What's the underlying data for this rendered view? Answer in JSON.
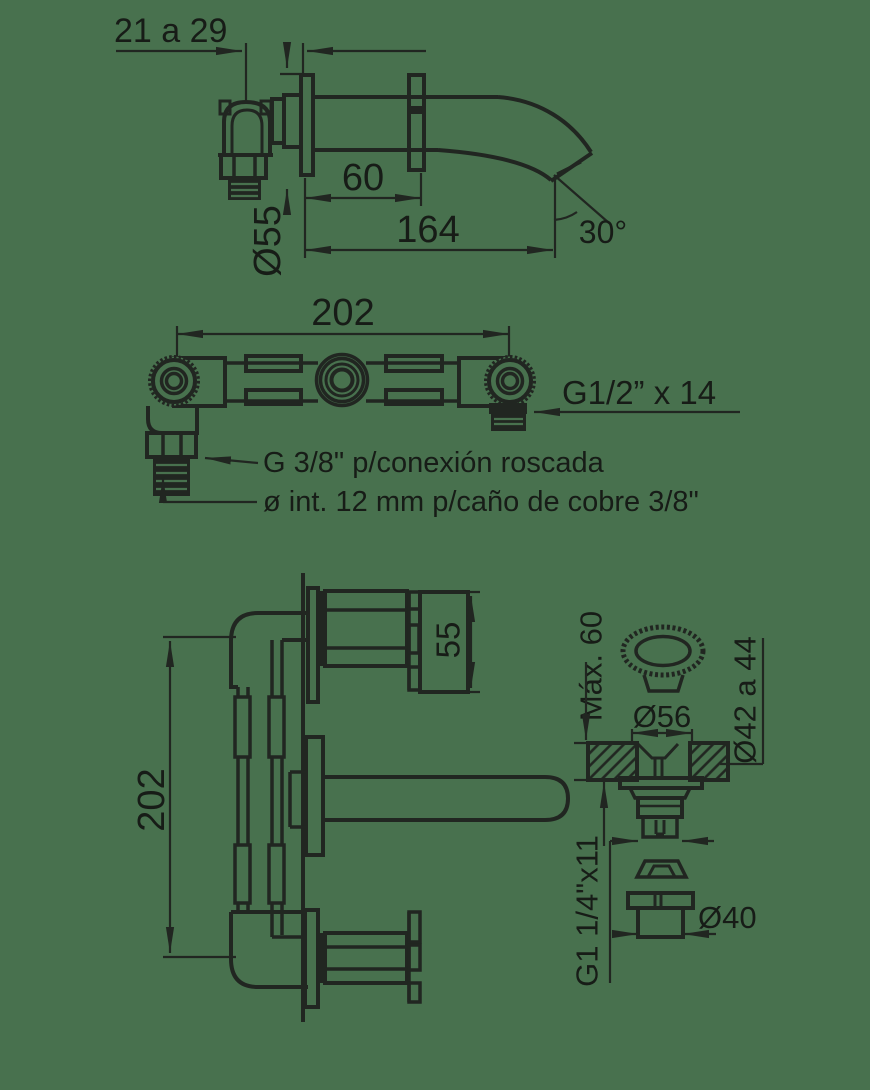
{
  "colors": {
    "bg": "#48714E",
    "line": "#212621",
    "ink": "#171C17"
  },
  "drawings": {
    "spout_side_view": {
      "wall_thickness_range": "21 a 29",
      "inner_projection": "60",
      "total_projection": "164",
      "spout_angle": "30°",
      "flange_diameter": "Ø55"
    },
    "manifold_front_view": {
      "center_distance": "202",
      "outlet_thread": "G1/2” x 14",
      "threaded_connection_note": "G 3/8\" p/conexión roscada",
      "copper_pipe_note": "ø int. 12 mm p/caño de cobre 3/8\""
    },
    "installed_side_view": {
      "center_distance": "202",
      "handle_diameter": "55"
    },
    "popup_drain_view": {
      "max_deck_thickness": "Máx. 60",
      "knob_diameter": "Ø56",
      "hole_diameter_range": "Ø42 a 44",
      "body_thread": "G1 1/4\"x11",
      "tailpiece_diameter": "Ø40"
    }
  }
}
